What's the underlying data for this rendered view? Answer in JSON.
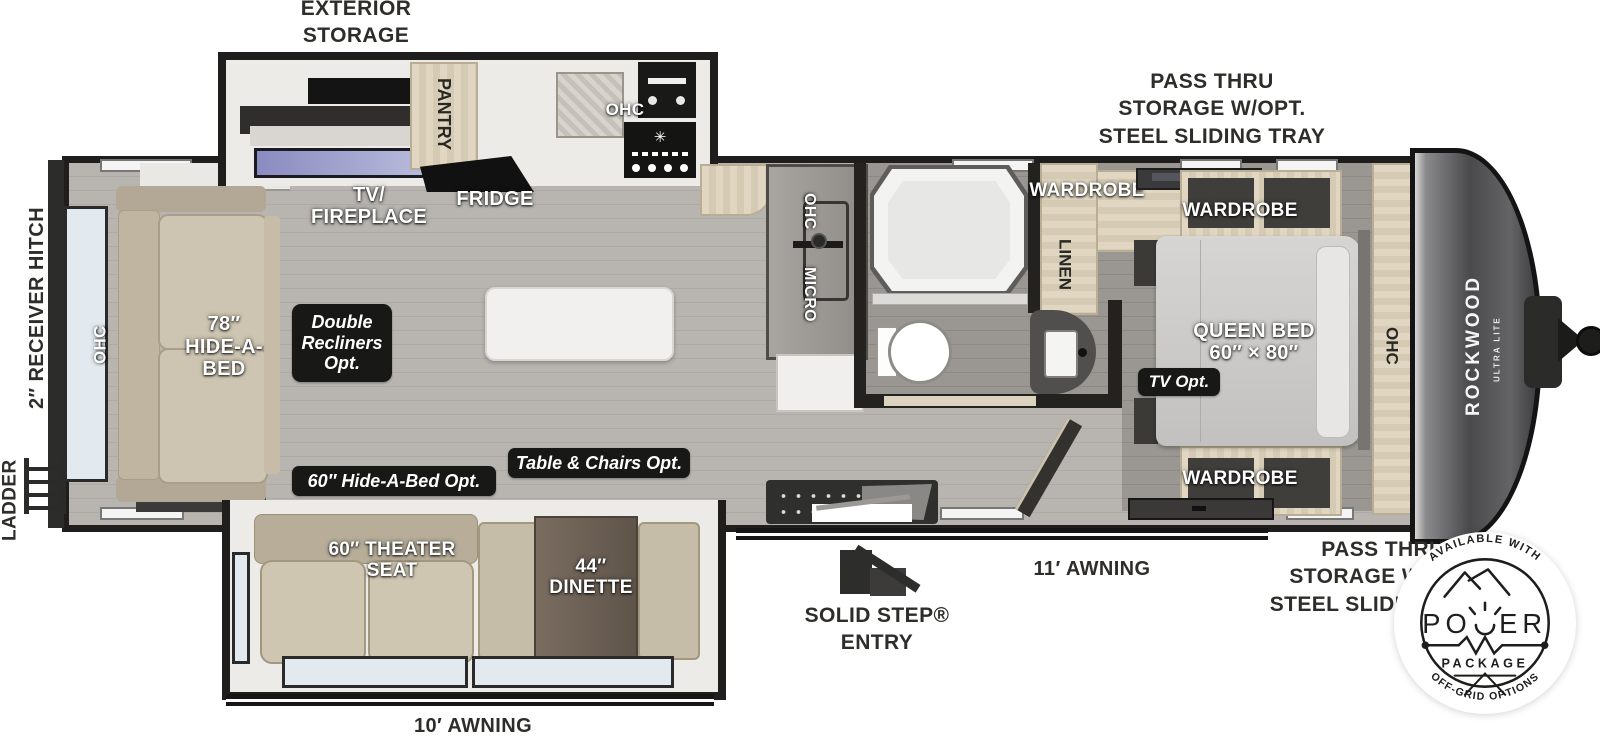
{
  "title": "Rockwood Ultra Lite travel trailer floor plan",
  "colors": {
    "wall": "#1f1e1c",
    "floor": "#b5b2ad",
    "floor_dark": "#96938e",
    "cabinet_tan": "#d8ceb9",
    "sofa": "#cdc4b1",
    "badge_bg": "#181816",
    "window_glass": "#e3eaef",
    "fireplace_screen": "#9a9cc8",
    "front_cap": "#4a4a4d",
    "island": "#f1f0ee",
    "dinette_table": "#6f6255"
  },
  "icons": {
    "burner_star": "✳"
  },
  "exterior": {
    "exterior_storage": "EXTERIOR\nSTORAGE",
    "pass_thru_top": "PASS THRU\nSTORAGE W/OPT.\nSTEEL SLIDING TRAY",
    "pass_thru_bottom": "PASS THRU\nSTORAGE W/OPT.\nSTEEL SLIDING TRAY",
    "receiver_hitch": "2″ RECEIVER HITCH",
    "ladder": "LADDER",
    "awning_rear": "10′ AWNING",
    "awning_front": "11′ AWNING",
    "entry": "SOLID STEP®\nENTRY"
  },
  "living": {
    "tv_fireplace": "TV/\nFIREPLACE",
    "fridge": "FRIDGE",
    "pantry": "PANTRY",
    "ohc_kitchen": "OHC",
    "ohc_wall": "OHC",
    "micro": "MICRO",
    "ohc_rear": "OHC",
    "hide_a_bed": "78″\nHIDE-A-\nBED",
    "theater_seat": "60″ THEATER\nSEAT",
    "dinette": "44″\nDINETTE"
  },
  "bedroom": {
    "wardrobe_bath": "WARDROBE",
    "linen": "LINEN",
    "wardrobe_top": "WARDROBE",
    "wardrobe_bottom": "WARDROBE",
    "queen_bed": "QUEEN BED\n60″ × 80″",
    "ohc_front": "OHC"
  },
  "badges": {
    "double_recliners": "Double\nRecliners\nOpt.",
    "hide_a_bed_opt": "60″ Hide-A-Bed Opt.",
    "table_chairs_opt": "Table & Chairs Opt.",
    "tv_opt": "TV Opt."
  },
  "brand": {
    "name": "ROCKWOOD",
    "sub": "ULTRA LITE"
  },
  "power_badge": {
    "top_arc": "AVAILABLE WITH",
    "power_left": "PO",
    "power_right": "ER",
    "package": "PACKAGE",
    "bottom_arc": "OFF-GRID OPTIONS"
  }
}
